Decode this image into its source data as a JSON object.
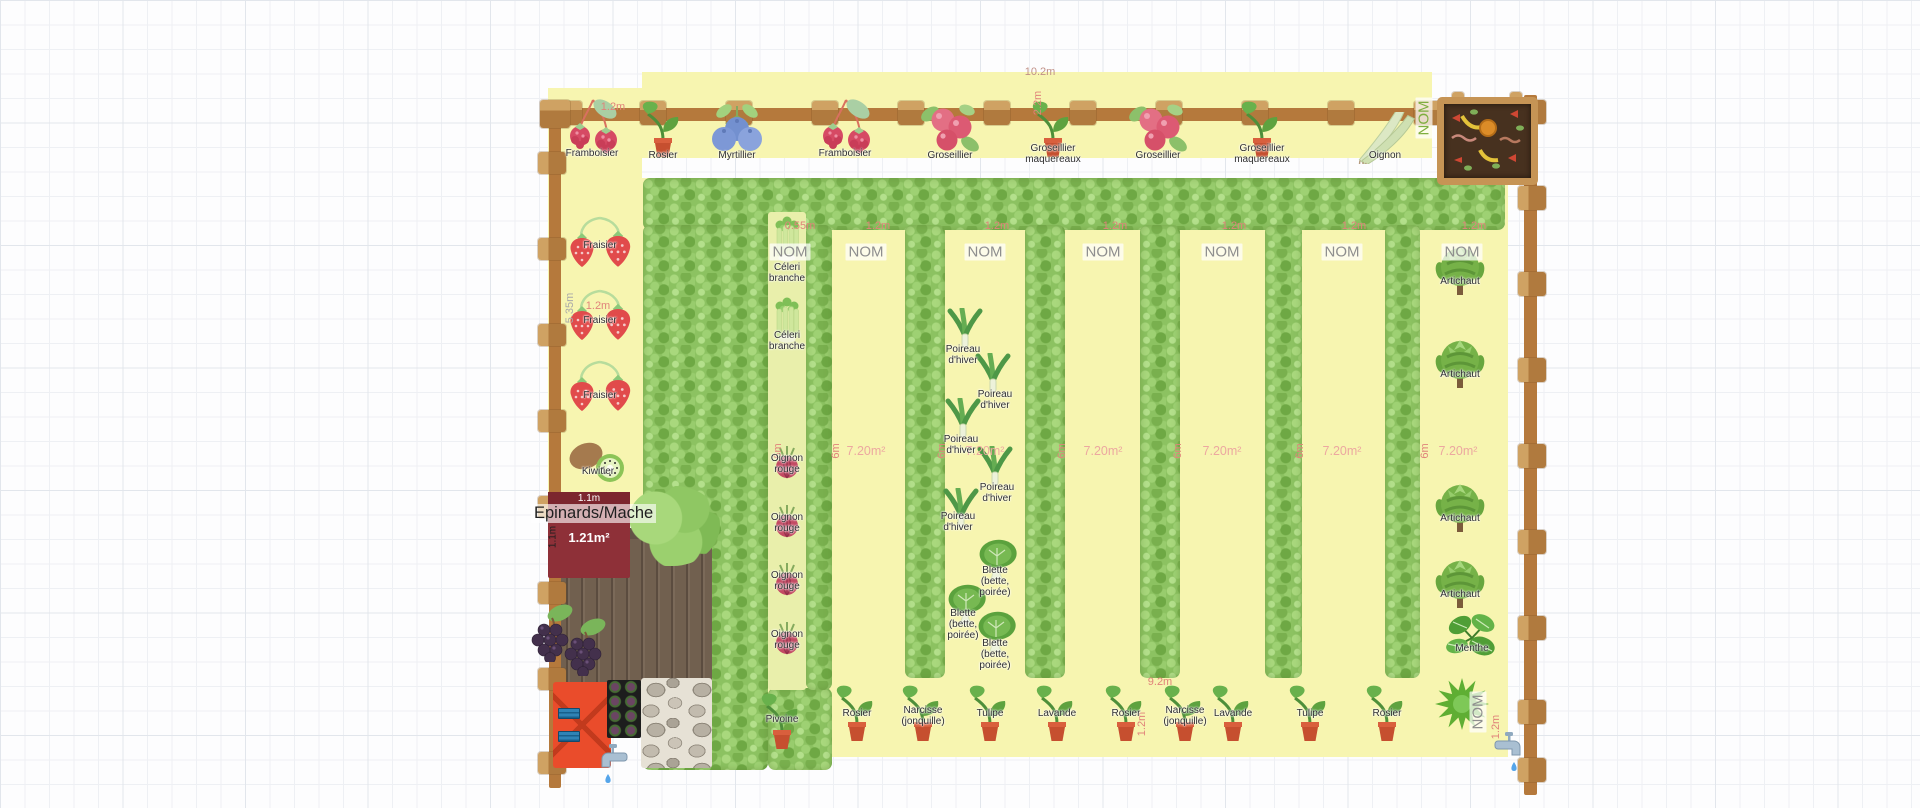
{
  "garden": {
    "nom_label": "NOM",
    "top_band_length": "10.2m",
    "top_band_cell": "1.2m",
    "top_band_depth": "2.2m",
    "left_column_height": "5.35m",
    "left_column_width": "1.2m",
    "celery_strip_width": "0.55m",
    "bed_width": "1.2m",
    "bed_height": "6m",
    "bed_area": "7.20m²",
    "bottom_strip_width": "9.2m",
    "corner_width": "1.2m"
  },
  "epinards_bed": {
    "name": "Epinards/Mache",
    "width_label": "1.1m",
    "height_label": "1.1m",
    "area_label": "1.21m²"
  },
  "colors": {
    "bed_yellow": "#f7f5b0",
    "hedge_green": "#8cc261",
    "fence_brown": "#b5793c",
    "dimension_red": "#e0837a",
    "nom_gray": "#8e8e8e",
    "epinards_red": "#8e3038"
  },
  "areas": [
    {
      "x": 548,
      "y": 88,
      "w": 94,
      "h": 70
    },
    {
      "x": 548,
      "y": 158,
      "w": 94,
      "h": 362
    },
    {
      "x": 642,
      "y": 72,
      "w": 790,
      "h": 86
    },
    {
      "x": 642,
      "y": 178,
      "w": 866,
      "h": 579
    }
  ],
  "celery_strip": {
    "x": 768,
    "y": 212,
    "w": 38,
    "h": 478
  },
  "hedges": [
    {
      "x": 643,
      "y": 178,
      "w": 862,
      "h": 52
    },
    {
      "x": 643,
      "y": 225,
      "w": 125,
      "h": 545
    },
    {
      "x": 768,
      "y": 688,
      "w": 64,
      "h": 82
    },
    {
      "x": 806,
      "y": 225,
      "w": 26,
      "h": 465
    },
    {
      "x": 905,
      "y": 225,
      "w": 40,
      "h": 453
    },
    {
      "x": 1025,
      "y": 225,
      "w": 40,
      "h": 453
    },
    {
      "x": 1140,
      "y": 225,
      "w": 40,
      "h": 453
    },
    {
      "x": 1265,
      "y": 225,
      "w": 37,
      "h": 453
    },
    {
      "x": 1385,
      "y": 225,
      "w": 35,
      "h": 453
    }
  ],
  "fence": {
    "top_rail": {
      "x": 548,
      "y": 108,
      "w": 990,
      "h": 13
    },
    "left_rail": {
      "x": 549,
      "y": 108,
      "w": 12,
      "h": 680
    },
    "right_rail": {
      "x": 1524,
      "y": 95,
      "w": 13,
      "h": 700
    },
    "top_posts_x": [
      556,
      640,
      726,
      812,
      898,
      984,
      1070,
      1156,
      1242,
      1328,
      1414,
      1496
    ],
    "left_posts_y": [
      152,
      238,
      324,
      410,
      496,
      582,
      668,
      752
    ],
    "right_posts_y": [
      100,
      186,
      272,
      358,
      444,
      530,
      616,
      700,
      758
    ]
  },
  "noms": [
    {
      "x": 790,
      "y": 252
    },
    {
      "x": 866,
      "y": 252
    },
    {
      "x": 985,
      "y": 252
    },
    {
      "x": 1103,
      "y": 252
    },
    {
      "x": 1222,
      "y": 252
    },
    {
      "x": 1342,
      "y": 252
    },
    {
      "x": 1462,
      "y": 252
    },
    {
      "x": 1478,
      "y": 712,
      "rot": true
    },
    {
      "x": 1424,
      "y": 118,
      "rot": true,
      "green": true
    }
  ],
  "texts": [
    {
      "t": "10.2m",
      "x": 1040,
      "y": 72,
      "cls": "dimbig"
    },
    {
      "t": "1.2m",
      "x": 613,
      "y": 107,
      "cls": "dim"
    },
    {
      "t": "2.2m",
      "x": 1038,
      "y": 103,
      "cls": "dim rot"
    },
    {
      "t": "1.2m",
      "x": 598,
      "y": 306,
      "cls": "dim"
    },
    {
      "t": "5.35m",
      "x": 570,
      "y": 308,
      "cls": "gray rot"
    },
    {
      "t": "0.55m",
      "x": 800,
      "y": 226,
      "cls": "dim"
    },
    {
      "t": "1.2m",
      "x": 878,
      "y": 226,
      "cls": "dim"
    },
    {
      "t": "1.2m",
      "x": 997,
      "y": 226,
      "cls": "dim"
    },
    {
      "t": "1.2m",
      "x": 1115,
      "y": 226,
      "cls": "dim"
    },
    {
      "t": "1.2m",
      "x": 1234,
      "y": 226,
      "cls": "dim"
    },
    {
      "t": "1.2m",
      "x": 1354,
      "y": 226,
      "cls": "dim"
    },
    {
      "t": "1.2m",
      "x": 1474,
      "y": 226,
      "cls": "dim"
    },
    {
      "t": "7.20m²",
      "x": 866,
      "y": 451,
      "cls": "areaL"
    },
    {
      "t": "7.20m²",
      "x": 985,
      "y": 451,
      "cls": "areaL"
    },
    {
      "t": "7.20m²",
      "x": 1103,
      "y": 451,
      "cls": "areaL"
    },
    {
      "t": "7.20m²",
      "x": 1222,
      "y": 451,
      "cls": "areaL"
    },
    {
      "t": "7.20m²",
      "x": 1342,
      "y": 451,
      "cls": "areaL"
    },
    {
      "t": "7.20m²",
      "x": 1458,
      "y": 451,
      "cls": "areaL"
    },
    {
      "t": "6m",
      "x": 778,
      "y": 451,
      "cls": "dim rot"
    },
    {
      "t": "6m",
      "x": 836,
      "y": 451,
      "cls": "dim rot"
    },
    {
      "t": "6m",
      "x": 942,
      "y": 451,
      "cls": "dim rot"
    },
    {
      "t": "6m",
      "x": 1062,
      "y": 451,
      "cls": "dim rot"
    },
    {
      "t": "6m",
      "x": 1178,
      "y": 451,
      "cls": "dim rot"
    },
    {
      "t": "6m",
      "x": 1300,
      "y": 451,
      "cls": "dim rot"
    },
    {
      "t": "6m",
      "x": 1425,
      "y": 451,
      "cls": "dim rot"
    },
    {
      "t": "9.2m",
      "x": 1160,
      "y": 682,
      "cls": "dim"
    },
    {
      "t": "1.2m",
      "x": 1142,
      "y": 724,
      "cls": "dim rot"
    },
    {
      "t": "1.2m",
      "x": 1496,
      "y": 727,
      "cls": "dim rot"
    }
  ],
  "plants": [
    {
      "icon": "raspberry",
      "label": "Framboisier",
      "x": 592,
      "y": 96,
      "ly": 148
    },
    {
      "icon": "pot",
      "label": "Rosier",
      "x": 663,
      "y": 100,
      "ly": 150
    },
    {
      "icon": "blueberry",
      "label": "Myrtillier",
      "x": 737,
      "y": 102,
      "ly": 150
    },
    {
      "icon": "raspberry",
      "label": "Framboisier",
      "x": 845,
      "y": 96,
      "ly": 148
    },
    {
      "icon": "currant",
      "label": "Groseillier",
      "x": 950,
      "y": 100,
      "ly": 150
    },
    {
      "icon": "pot",
      "label": "Groseillier\nmaquereaux",
      "x": 1053,
      "y": 100,
      "ly": 143
    },
    {
      "icon": "currant",
      "label": "Groseillier",
      "x": 1158,
      "y": 100,
      "ly": 150
    },
    {
      "icon": "pot",
      "label": "Groseillier\nmaquereaux",
      "x": 1262,
      "y": 100,
      "ly": 143
    },
    {
      "icon": "leekh",
      "label": "Oignon",
      "x": 1385,
      "y": 112,
      "ly": 150
    },
    {
      "icon": "strawberry",
      "label": "Fraisier",
      "x": 600,
      "y": 212,
      "ly": 240
    },
    {
      "icon": "strawberry",
      "label": "Fraisier",
      "x": 600,
      "y": 285,
      "ly": 315
    },
    {
      "icon": "strawberry",
      "label": "Fraisier",
      "x": 600,
      "y": 356,
      "ly": 390
    },
    {
      "icon": "kiwi",
      "label": "Kiwitier",
      "x": 598,
      "y": 436,
      "ly": 466
    },
    {
      "icon": "celery",
      "label": "Céleri\nbranche",
      "x": 787,
      "y": 215,
      "ly": 262
    },
    {
      "icon": "celery",
      "label": "Céleri\nbranche",
      "x": 787,
      "y": 296,
      "ly": 330
    },
    {
      "icon": "onion",
      "label": "Oignon\nrouge",
      "x": 787,
      "y": 443,
      "ly": 453
    },
    {
      "icon": "onion",
      "label": "Oignon\nrouge",
      "x": 787,
      "y": 502,
      "ly": 512
    },
    {
      "icon": "onion",
      "label": "Oignon\nrouge",
      "x": 787,
      "y": 560,
      "ly": 570
    },
    {
      "icon": "onion",
      "label": "Oignon\nrouge",
      "x": 787,
      "y": 619,
      "ly": 629
    },
    {
      "icon": "leek",
      "label": "Poireau\nd'hiver",
      "x": 965,
      "y": 308,
      "lx": 963,
      "ly": 344
    },
    {
      "icon": "leek",
      "label": "Poireau\nd'hiver",
      "x": 993,
      "y": 353,
      "lx": 995,
      "ly": 389
    },
    {
      "icon": "leek",
      "label": "Poireau\nd'hiver",
      "x": 963,
      "y": 398,
      "lx": 961,
      "ly": 434
    },
    {
      "icon": "leek",
      "label": "Poireau\nd'hiver",
      "x": 995,
      "y": 446,
      "lx": 997,
      "ly": 482
    },
    {
      "icon": "leek",
      "label": "Poireau\nd'hiver",
      "x": 961,
      "y": 488,
      "lx": 958,
      "ly": 511
    },
    {
      "icon": "chard",
      "label": "Blette\n(bette,\npoirée)",
      "x": 997,
      "y": 538,
      "lx": 995,
      "ly": 565
    },
    {
      "icon": "chard",
      "label": "Blette\n(bette,\npoirée)",
      "x": 966,
      "y": 583,
      "lx": 963,
      "ly": 608
    },
    {
      "icon": "chard",
      "label": "Blette\n(bette,\npoirée)",
      "x": 996,
      "y": 610,
      "lx": 995,
      "ly": 638
    },
    {
      "icon": "artichoke",
      "label": "Artichaut",
      "x": 1460,
      "y": 243,
      "ly": 276
    },
    {
      "icon": "artichoke",
      "label": "Artichaut",
      "x": 1460,
      "y": 336,
      "ly": 369
    },
    {
      "icon": "artichoke",
      "label": "Artichaut",
      "x": 1460,
      "y": 480,
      "ly": 513
    },
    {
      "icon": "artichoke",
      "label": "Artichaut",
      "x": 1460,
      "y": 556,
      "ly": 589
    },
    {
      "icon": "mint",
      "label": "Menthe",
      "x": 1472,
      "y": 612,
      "ly": 643
    },
    {
      "icon": "spiky",
      "label": "",
      "x": 1462,
      "y": 678
    },
    {
      "icon": "pot",
      "label": "Pivoine",
      "x": 782,
      "y": 692,
      "ly": 714
    },
    {
      "icon": "pot",
      "label": "Rosier",
      "x": 857,
      "y": 684,
      "ly": 708
    },
    {
      "icon": "pot",
      "label": "Narcisse\n(jonquille)",
      "x": 923,
      "y": 684,
      "ly": 705
    },
    {
      "icon": "pot",
      "label": "Tulipe",
      "x": 990,
      "y": 684,
      "ly": 708
    },
    {
      "icon": "pot",
      "label": "Lavande",
      "x": 1057,
      "y": 684,
      "ly": 708
    },
    {
      "icon": "pot",
      "label": "Rosier",
      "x": 1126,
      "y": 684,
      "ly": 708
    },
    {
      "icon": "pot",
      "label": "Narcisse\n(jonquille)",
      "x": 1185,
      "y": 684,
      "ly": 705
    },
    {
      "icon": "pot",
      "label": "Lavande",
      "x": 1233,
      "y": 684,
      "ly": 708
    },
    {
      "icon": "pot",
      "label": "Tulipe",
      "x": 1310,
      "y": 684,
      "ly": 708
    },
    {
      "icon": "pot",
      "label": "Rosier",
      "x": 1387,
      "y": 684,
      "ly": 708
    },
    {
      "icon": "grapes",
      "label": "",
      "x": 552,
      "y": 604
    },
    {
      "icon": "grapes",
      "label": "",
      "x": 585,
      "y": 618
    }
  ]
}
